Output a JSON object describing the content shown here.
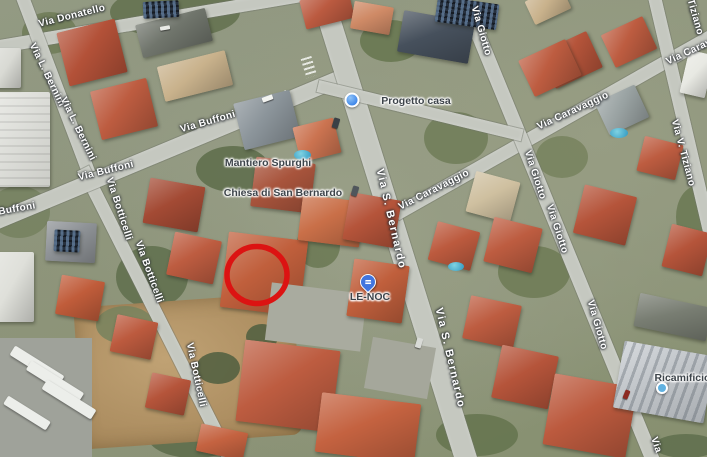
{
  "map": {
    "view_type": "satellite",
    "annotation": {
      "shape": "circle",
      "color": "#dc1312",
      "center_x": 257,
      "center_y": 275
    },
    "colors": {
      "road_label": "#ffffff",
      "poi_label": "#3d444a",
      "road_fill": "#c5c8c0",
      "pin_blue": "#4175df",
      "dot_blue": "#3d85e8",
      "dot_teal": "#61b1e0"
    },
    "road_labels": [
      {
        "text": "Via Donatello"
      },
      {
        "text": "Via L. Bernini"
      },
      {
        "text": "Via L. Bernini"
      },
      {
        "text": "Via Buffoni"
      },
      {
        "text": "Via Buffoni"
      },
      {
        "text": "Buffoni"
      },
      {
        "text": "Via Botticelli"
      },
      {
        "text": "Via Botticelli"
      },
      {
        "text": "Via Botticelli"
      },
      {
        "text": "Via S. Bernardo"
      },
      {
        "text": "Via S. Bernardo"
      },
      {
        "text": "Via Caravaggio"
      },
      {
        "text": "Via Caravaggio"
      },
      {
        "text": "Via Caravaggio"
      },
      {
        "text": "Via Giotto"
      },
      {
        "text": "Via Giotto"
      },
      {
        "text": "Via Giotto"
      },
      {
        "text": "Via Giotto"
      },
      {
        "text": "Tiziano"
      },
      {
        "text": "Via V. Tiziano"
      },
      {
        "text": "Via"
      }
    ],
    "poi_labels": [
      {
        "text": "Mantiero Spurghi"
      },
      {
        "text": "Chiesa di San Bernardo"
      },
      {
        "text": "Progetto casa",
        "icon": "blue-dot-icon"
      },
      {
        "text": "LE-NOC",
        "icon": "blue-place-pin-icon"
      },
      {
        "text": "Ricamificio G",
        "icon": "teal-dot-icon"
      }
    ]
  }
}
